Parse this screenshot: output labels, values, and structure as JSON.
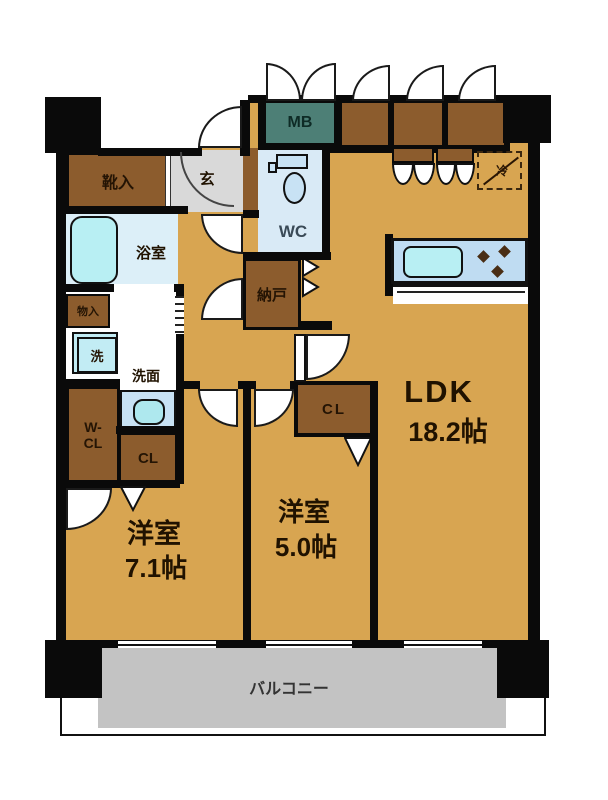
{
  "plan": {
    "ldk": {
      "name": "LDK",
      "size": "18.2帖"
    },
    "bedroom_main": {
      "name": "洋室",
      "size": "7.1帖"
    },
    "bedroom_second": {
      "name": "洋室",
      "size": "5.0帖"
    },
    "balcony": {
      "name": "バルコニー"
    },
    "entrance": {
      "name": "玄"
    },
    "bathroom": {
      "name": "浴室"
    },
    "washroom": {
      "name": "洗面"
    },
    "toilet": {
      "name": "WC"
    },
    "storage_room": {
      "name": "納戸"
    },
    "meter_box": {
      "name": "MB"
    },
    "shoe_cabinet": {
      "name": "靴入"
    },
    "small_storage": {
      "name": "物入"
    },
    "washer": {
      "name": "洗"
    },
    "walk_in_closet": {
      "name": "W-\nCL"
    },
    "closet_main": {
      "name": "CL"
    },
    "closet_second": {
      "name": "CL"
    },
    "refrigerator": {
      "name": "冷"
    }
  },
  "colors": {
    "floor": "#D8A551",
    "cabinet_brown": "#8C5C2D",
    "meter_box_teal": "#4D7F76",
    "water_blue": "#DCEFF8",
    "bathtub_cyan": "#B8EFF3",
    "entrance_gray": "#D9D9D9",
    "balcony_gray": "#C3C3C3",
    "wall_black": "#0A0A0A"
  }
}
